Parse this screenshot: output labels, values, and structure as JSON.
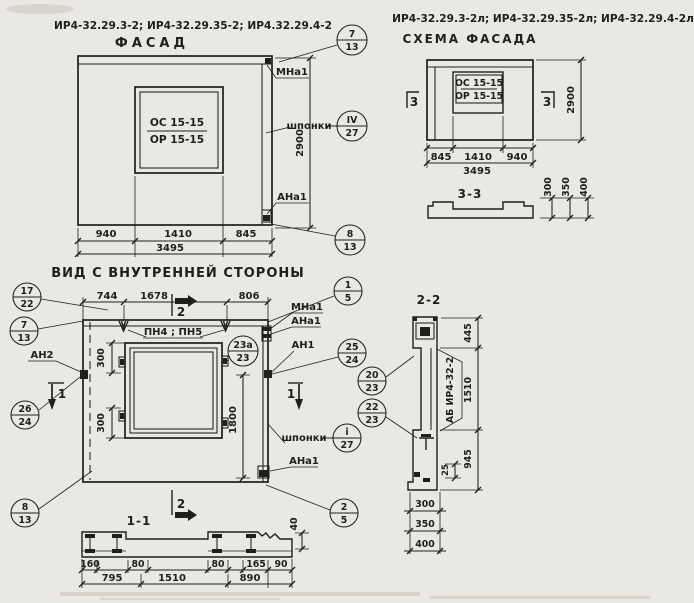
{
  "page": {
    "paper_color": "#eae8e2",
    "ink_color": "#201f1b"
  },
  "facade": {
    "codes": "ИР4-32.29.3-2; ИР4-32.29.35-2; ИР4.32.29.4-2",
    "title": "ФАСАД",
    "window_mark_top": "ОС 15-15",
    "window_mark_bottom": "ОР 15-15",
    "label_mna1": "МНа1",
    "label_shponki": "шпонки",
    "label_ana1": "АНа1",
    "dim_left": "940",
    "dim_mid": "1410",
    "dim_right": "845",
    "dim_total": "3495",
    "dim_height": "2900",
    "callout_top": {
      "num": "7",
      "sheet": "13"
    },
    "callout_shponki": {
      "num": "IV",
      "sheet": "27"
    },
    "callout_bottom": {
      "num": "8",
      "sheet": "13"
    }
  },
  "schema": {
    "codes": "ИР4-32.29.3-2л; ИР4-32.29.35-2л; ИР4-32.29.4-2л",
    "title": "СХЕМА ФАСАДА",
    "window_mark_top": "ОС 15-15",
    "window_mark_bottom": "ОР 15-15",
    "section_mark_left": "3",
    "section_mark_right": "3",
    "dim_left": "845",
    "dim_mid": "1410",
    "dim_right": "940",
    "dim_total": "3495",
    "dim_height": "2900"
  },
  "section33": {
    "title": "3-3",
    "dim_300": "300",
    "dim_350": "350",
    "dim_400": "400"
  },
  "plan": {
    "title": "ВИД С ВНУТРЕННЕЙ СТОРОНЫ",
    "dim_top_left": "744",
    "dim_top_mid": "1678",
    "dim_top_right": "806",
    "label_pn": "ПН4 ; ПН5",
    "label_mna1": "МНа1",
    "label_ana1_top": "АНа1",
    "label_an1": "АН1",
    "label_an2": "АН2",
    "label_shponki": "шпонки",
    "label_ana1_bottom": "АНа1",
    "dim_300_top": "300",
    "dim_300_bottom": "300",
    "dim_1800": "1800",
    "mark_sec1_left": "1",
    "mark_sec1_right": "1",
    "mark_sec2_top": "2",
    "mark_sec2_bottom": "2",
    "callout_17_22": {
      "num": "17",
      "sheet": "22"
    },
    "callout_7_13": {
      "num": "7",
      "sheet": "13"
    },
    "callout_26_24": {
      "num": "26",
      "sheet": "24"
    },
    "callout_8_13": {
      "num": "8",
      "sheet": "13"
    },
    "callout_1_5": {
      "num": "1",
      "sheet": "5"
    },
    "callout_23a_23": {
      "num": "23а",
      "sheet": "23"
    },
    "callout_25_24": {
      "num": "25",
      "sheet": "24"
    },
    "callout_i_27": {
      "num": "i",
      "sheet": "27"
    },
    "callout_2_5": {
      "num": "2",
      "sheet": "5"
    }
  },
  "section11": {
    "title": "1-1",
    "dim_160": "160",
    "dim_80a": "80",
    "dim_80b": "80",
    "dim_165": "165",
    "dim_90": "90",
    "dim_795": "795",
    "dim_1510": "1510",
    "dim_890": "890",
    "dim_40": "40"
  },
  "section22": {
    "title": "2-2",
    "block_label": "АБ ИР4-32-2",
    "dim_445": "445",
    "dim_1510": "1510",
    "dim_945": "945",
    "dim_25": "25",
    "dim_300": "300",
    "dim_350": "350",
    "dim_400": "400",
    "callout_20_23": {
      "num": "20",
      "sheet": "23"
    },
    "callout_22_23": {
      "num": "22",
      "sheet": "23"
    }
  }
}
